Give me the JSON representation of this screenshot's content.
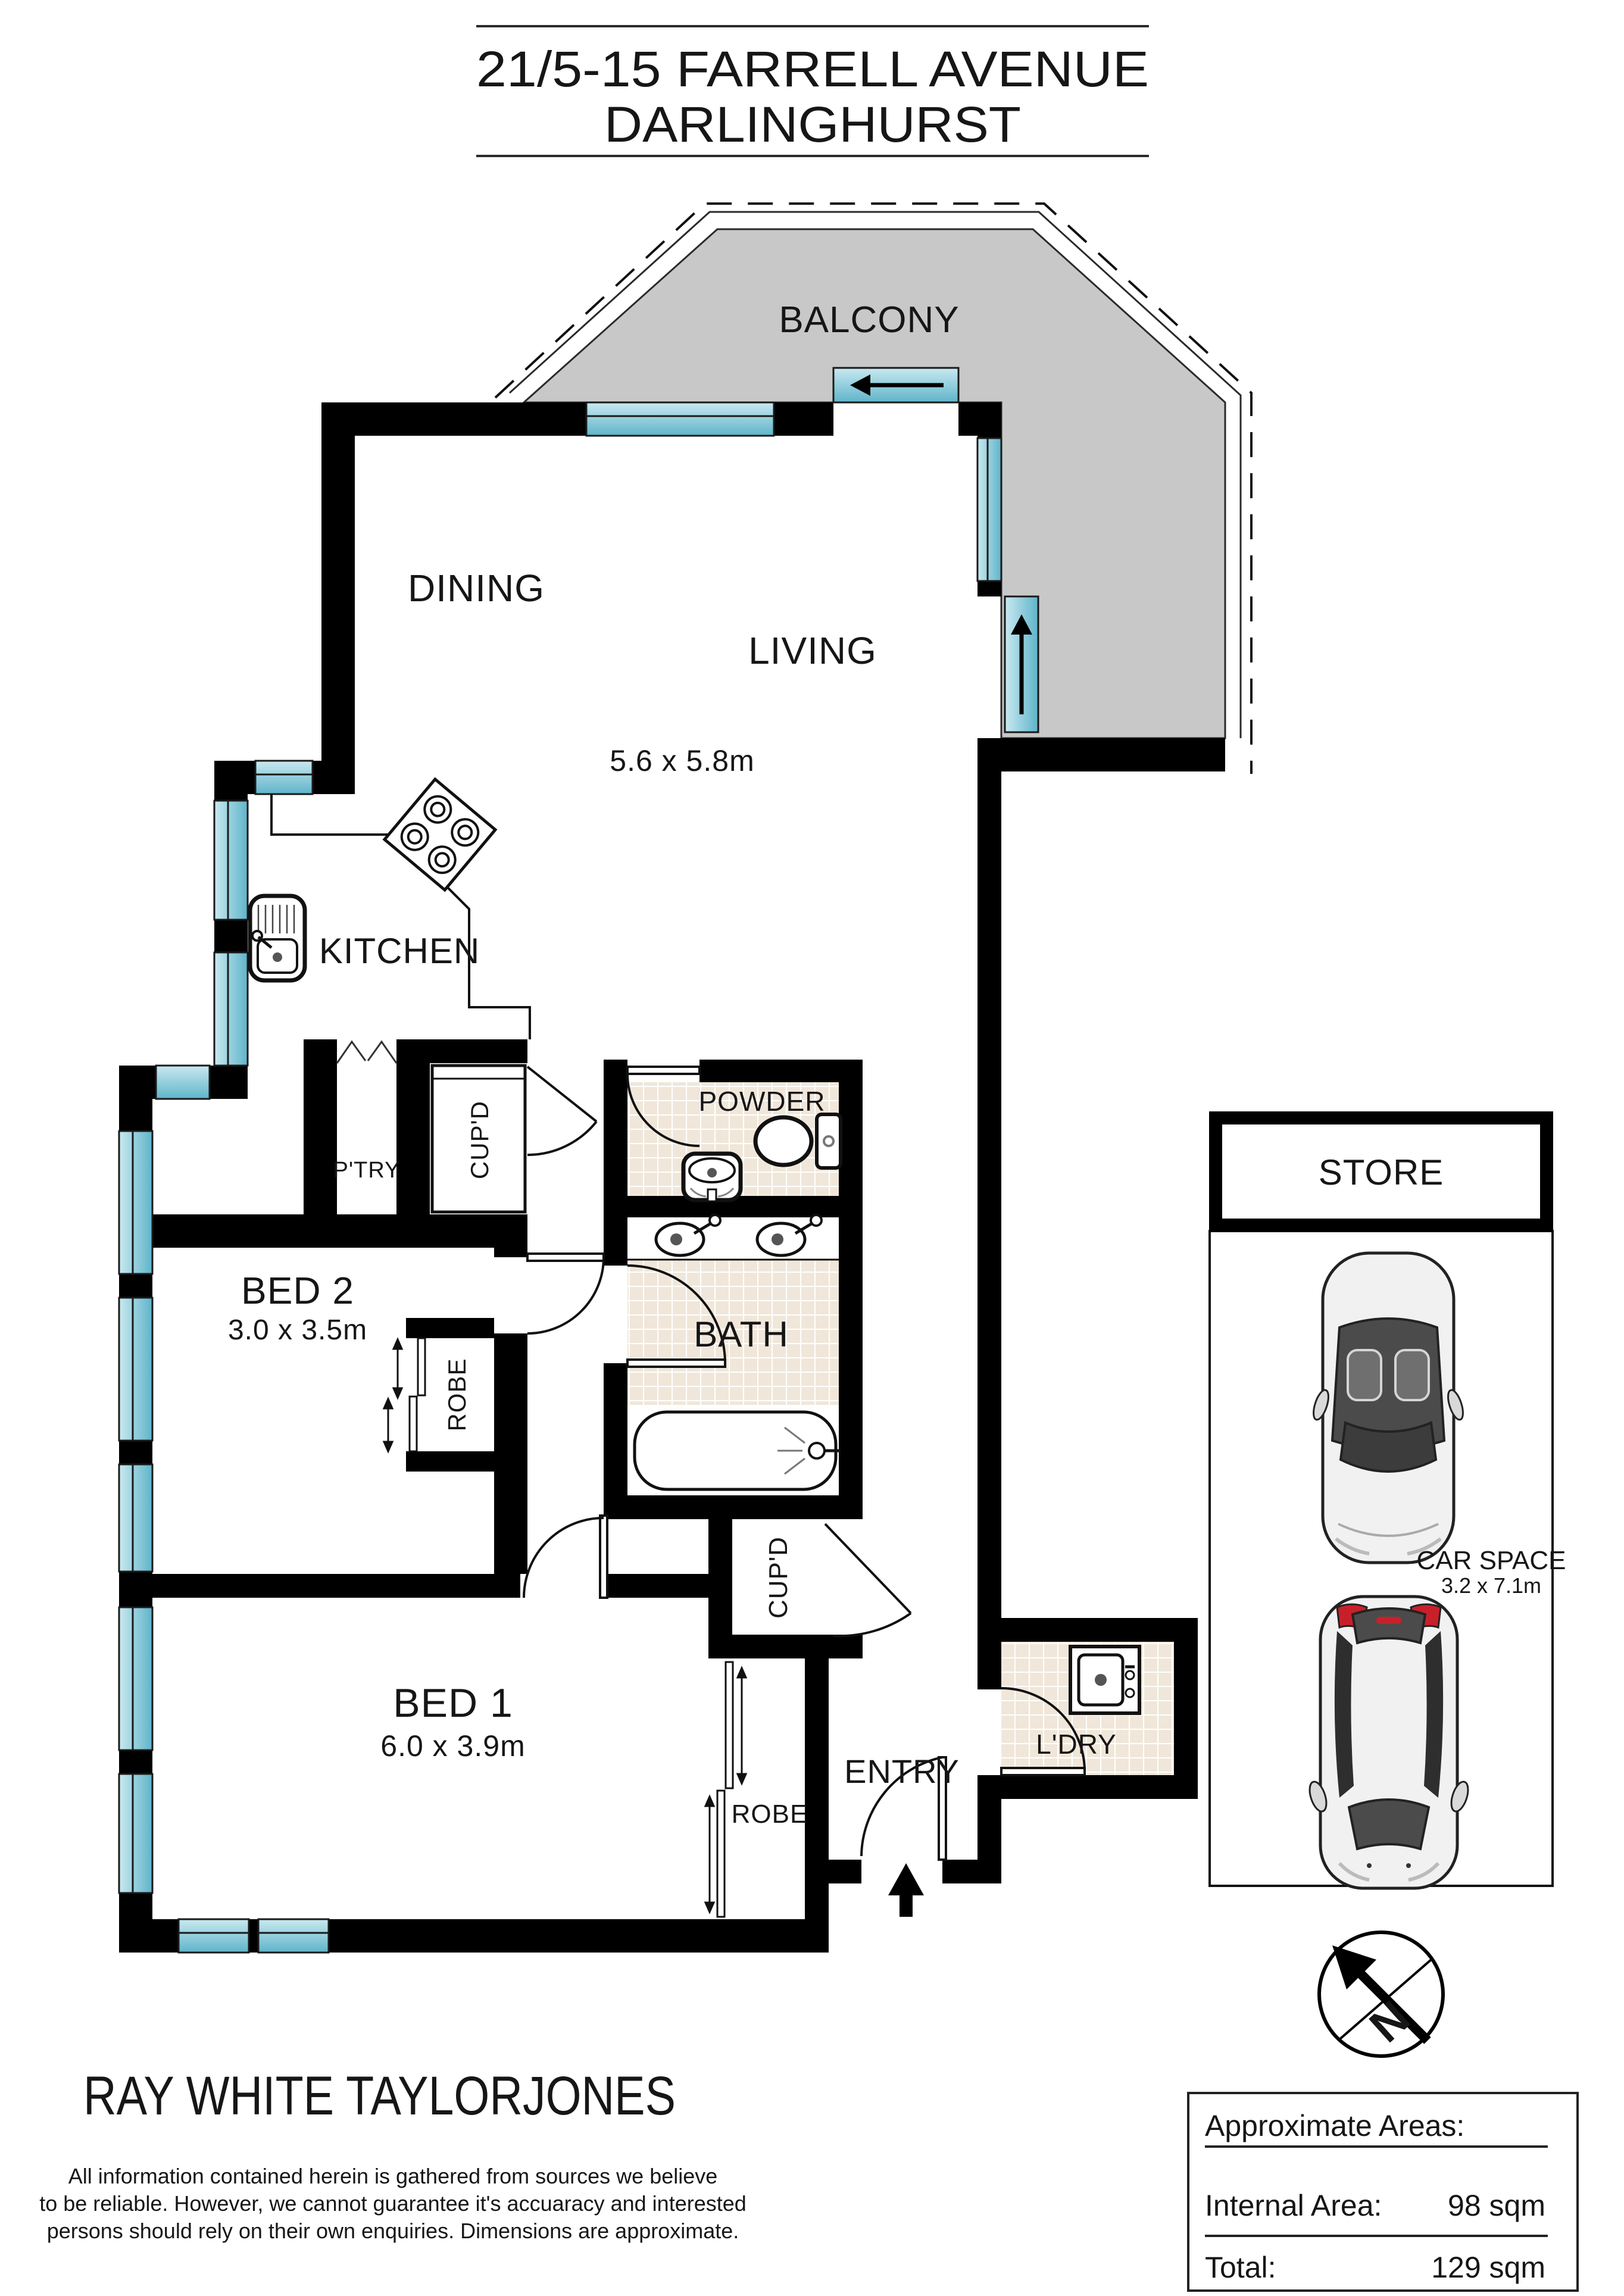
{
  "title": {
    "line1": "21/5-15 FARRELL AVENUE",
    "line2": "DARLINGHURST"
  },
  "rooms": {
    "balcony": "BALCONY",
    "dining": "DINING",
    "living": "LIVING",
    "living_dims": "5.6 x 5.8m",
    "kitchen": "KITCHEN",
    "pantry": "P'TRY",
    "cupboard_hall": "CUP'D",
    "cupboard_entry": "CUP'D",
    "bed2": "BED 2",
    "bed2_dims": "3.0 x 3.5m",
    "robe_bed2": "ROBE",
    "robe_bed1": "ROBE",
    "powder": "POWDER",
    "bath": "BATH",
    "bed1": "BED 1",
    "bed1_dims": "6.0 x 3.9m",
    "entry": "ENTRY",
    "laundry": "L'DRY"
  },
  "parking": {
    "store": "STORE",
    "car_space": "CAR SPACE",
    "car_space_dims": "3.2 x 7.1m"
  },
  "compass": {
    "north": "N"
  },
  "footer": {
    "brand": "RAY WHITE TAYLORJONES",
    "disclaimer_line1": "All information contained herein is gathered from sources we believe",
    "disclaimer_line2": "to be reliable. However, we cannot guarantee it's accuaracy and interested",
    "disclaimer_line3": "persons should rely on their own enquiries. Dimensions are approximate."
  },
  "areas": {
    "title": "Approximate Areas:",
    "internal_label": "Internal Area:",
    "internal_value": "98 sqm",
    "total_label": "Total:",
    "total_value": "129 sqm"
  },
  "colors": {
    "wall": "#000000",
    "window_light": "#c9e9f0",
    "window_dark": "#5fb4ca",
    "balcony_fill": "#c8c8c8",
    "tile_fill": "#f0e7da",
    "car_body": "#f1f1f1",
    "accent_red": "#c8202a"
  }
}
